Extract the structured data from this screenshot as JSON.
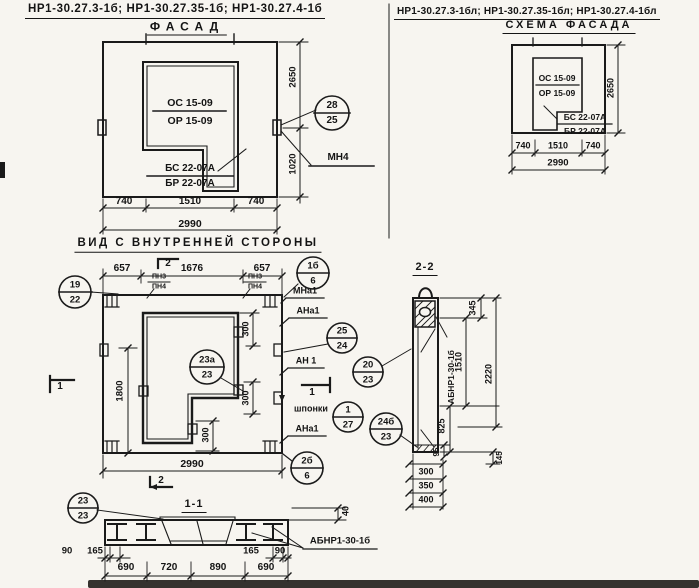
{
  "sheet": {
    "left_title": "НР1-30.27.3-1б;  НР1-30.27.35-1б;  НР1-30.27.4-1б",
    "right_title": "НР1-30.27.3-1бл; НР1-30.27.35-1бл; НР1-30.27.4-1бл"
  },
  "facade": {
    "subtitle": "ФАСАД",
    "opening_mark_top": "ОС 15-09",
    "opening_mark_bot": "ОР 15-09",
    "corner_mark_top": "БС 22-07А",
    "corner_mark_bot": "БР 22-07А",
    "dim_height": "2650",
    "dim_embed": "1020",
    "dim_left": "740",
    "dim_mid": "1510",
    "dim_right": "740",
    "dim_total": "2990",
    "callout": {
      "top": "28",
      "bot": "25"
    },
    "embed_label": "МН4"
  },
  "scheme": {
    "subtitle": "СХЕМА ФАСАДА",
    "opening_mark_top": "ОС 15-09",
    "opening_mark_bot": "ОР 15-09",
    "corner_mark_top": "БС 22-07А",
    "corner_mark_bot": "БР 22-07А",
    "dim_height": "2650",
    "dim_left": "740",
    "dim_mid": "1510",
    "dim_right": "740",
    "dim_total": "2990"
  },
  "inner_view": {
    "title": "ВИД С ВНУТРЕННЕЙ СТОРОНЫ",
    "dim_left": "657",
    "dim_mid": "1676",
    "dim_right": "657",
    "dim_opening_h": "1800",
    "dim_300": "300",
    "dim_total": "2990",
    "section_mark_1": "1",
    "section_mark_2": "2",
    "pn_top": "ПН3",
    "pn_bot": "ПН4",
    "label_mna1": "МНа1",
    "label_ana1": "АНа1",
    "label_an1": "АН 1",
    "label_shponki": "шпонки",
    "callout_19_22": {
      "top": "19",
      "bot": "22"
    },
    "callout_1b_6": {
      "top": "1б",
      "bot": "6"
    },
    "callout_23a_23": {
      "top": "23а",
      "bot": "23"
    },
    "callout_25_24": {
      "top": "25",
      "bot": "24"
    },
    "callout_20_23": {
      "top": "20",
      "bot": "23"
    },
    "callout_1_27": {
      "top": "1",
      "bot": "27"
    },
    "callout_24b_23": {
      "top": "24б",
      "bot": "23"
    },
    "callout_2b_6": {
      "top": "2б",
      "bot": "6"
    }
  },
  "section_2_2": {
    "title": "2-2",
    "beam_label": "АБНР1-30-1б",
    "dim_345": "345",
    "dim_1510": "1510",
    "dim_2220": "2220",
    "dim_825": "825",
    "dim_95": "95",
    "dim_145": "145",
    "dim_300": "300",
    "dim_350": "350",
    "dim_400": "400"
  },
  "section_1_1": {
    "title": "1-1",
    "beam_label": "АБНР1-30-1б",
    "callout": {
      "top": "23",
      "bot": "23"
    },
    "dim_40": "40",
    "dim_90": "90",
    "dim_165": "165",
    "dim_690a": "690",
    "dim_720": "720",
    "dim_890": "890",
    "dim_690b": "690"
  }
}
